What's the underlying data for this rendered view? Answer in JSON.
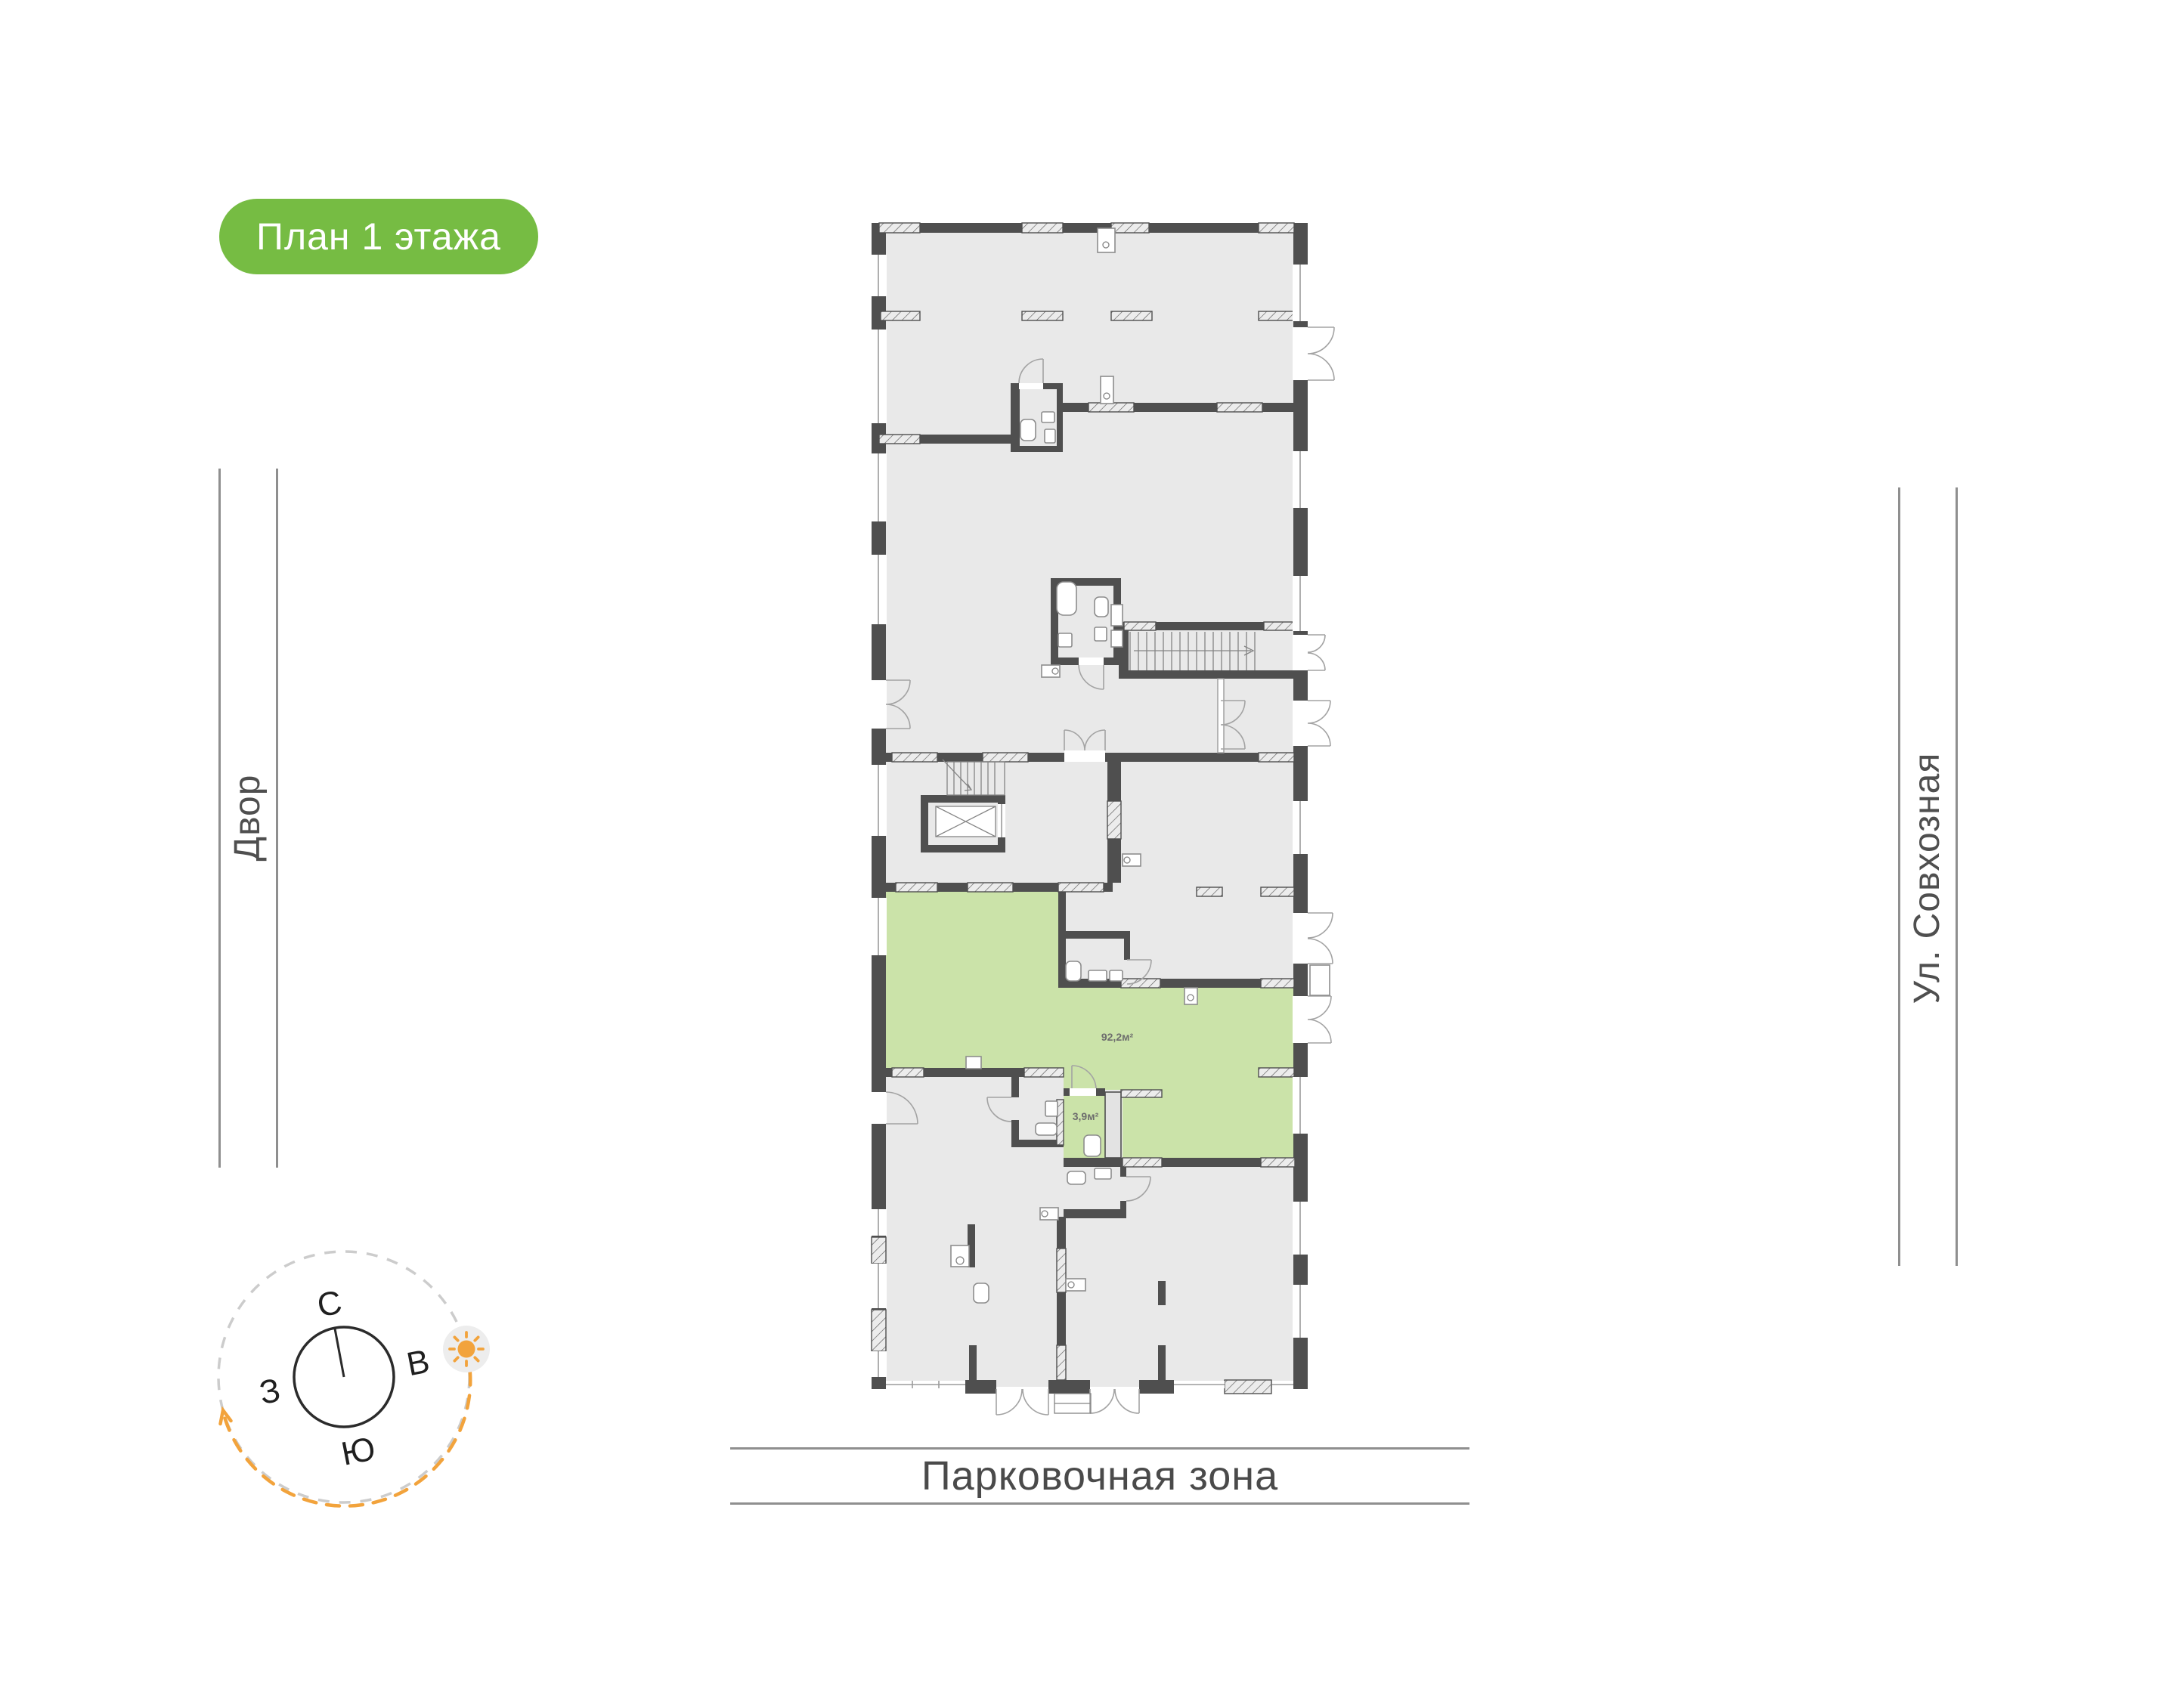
{
  "badge": {
    "label": "План 1 этажа"
  },
  "surroundings": {
    "courtyard": "Двор",
    "street": "Ул. Совхозная",
    "parking": "Парковочная зона"
  },
  "compass": {
    "north": "С",
    "east": "В",
    "south": "Ю",
    "west": "З"
  },
  "plan": {
    "highlighted_unit_area": "92,2м²",
    "wc_area": "3,9м²"
  },
  "colors": {
    "badge_green": "#76bc43",
    "unit_green": "#cbe3a9",
    "wall_dark": "#4f4f4f",
    "floor_gray": "#e9e9e9",
    "accent_orange": "#f2a33c"
  }
}
